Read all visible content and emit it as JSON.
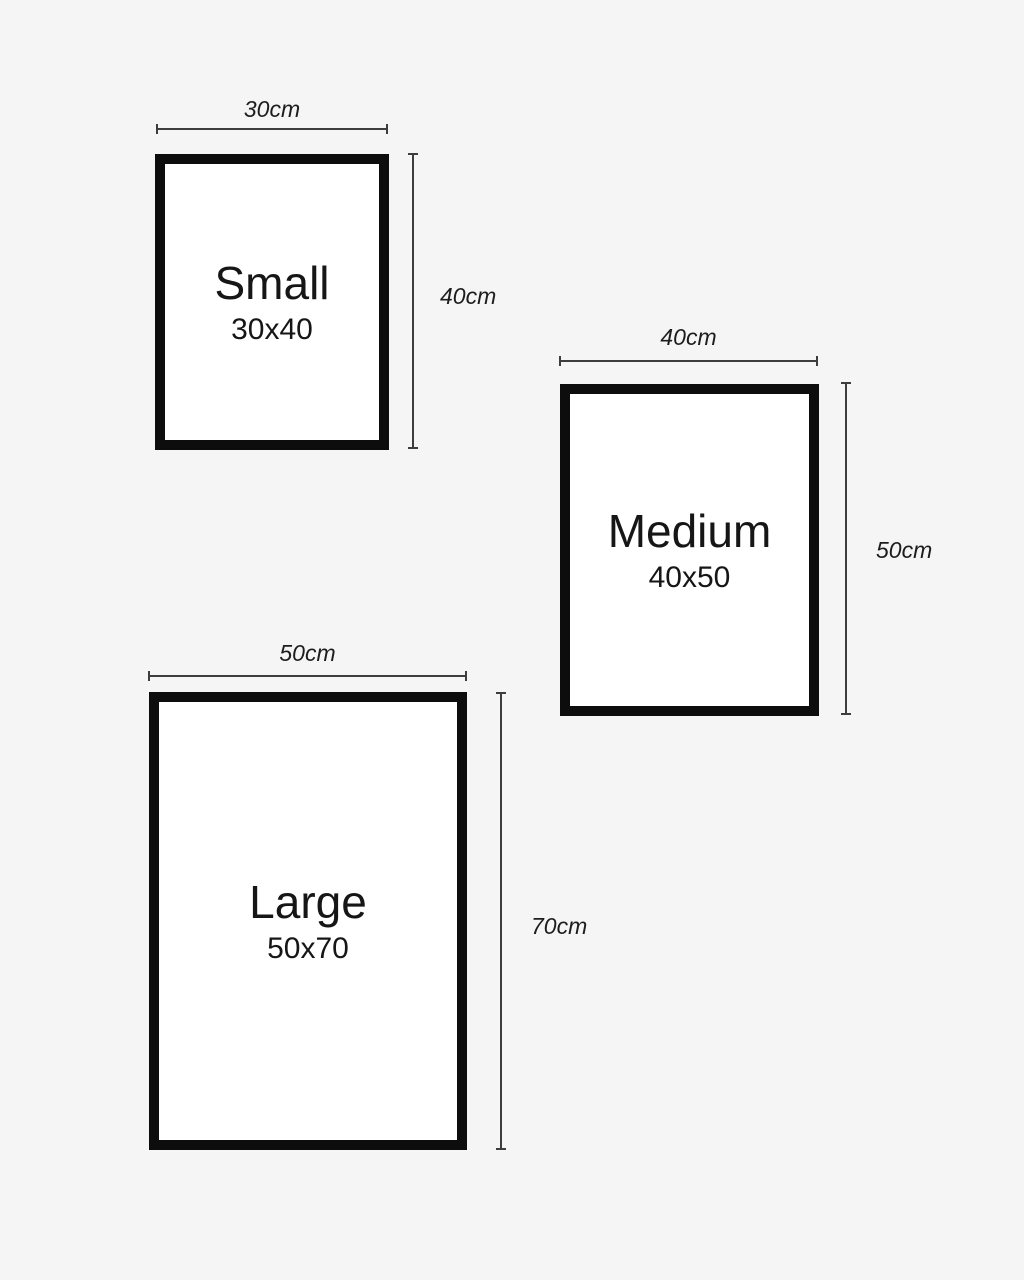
{
  "diagram": {
    "background_color": "#f5f5f5",
    "frame_border_color": "#0d0d0d",
    "frame_fill_color": "#ffffff",
    "dimension_line_color": "#3d3d3d",
    "text_color": "#161616",
    "frames": [
      {
        "name": "Small",
        "size": "30x40",
        "width_label": "30cm",
        "height_label": "40cm"
      },
      {
        "name": "Medium",
        "size": "40x50",
        "width_label": "40cm",
        "height_label": "50cm"
      },
      {
        "name": "Large",
        "size": "50x70",
        "width_label": "50cm",
        "height_label": "70cm"
      }
    ]
  }
}
